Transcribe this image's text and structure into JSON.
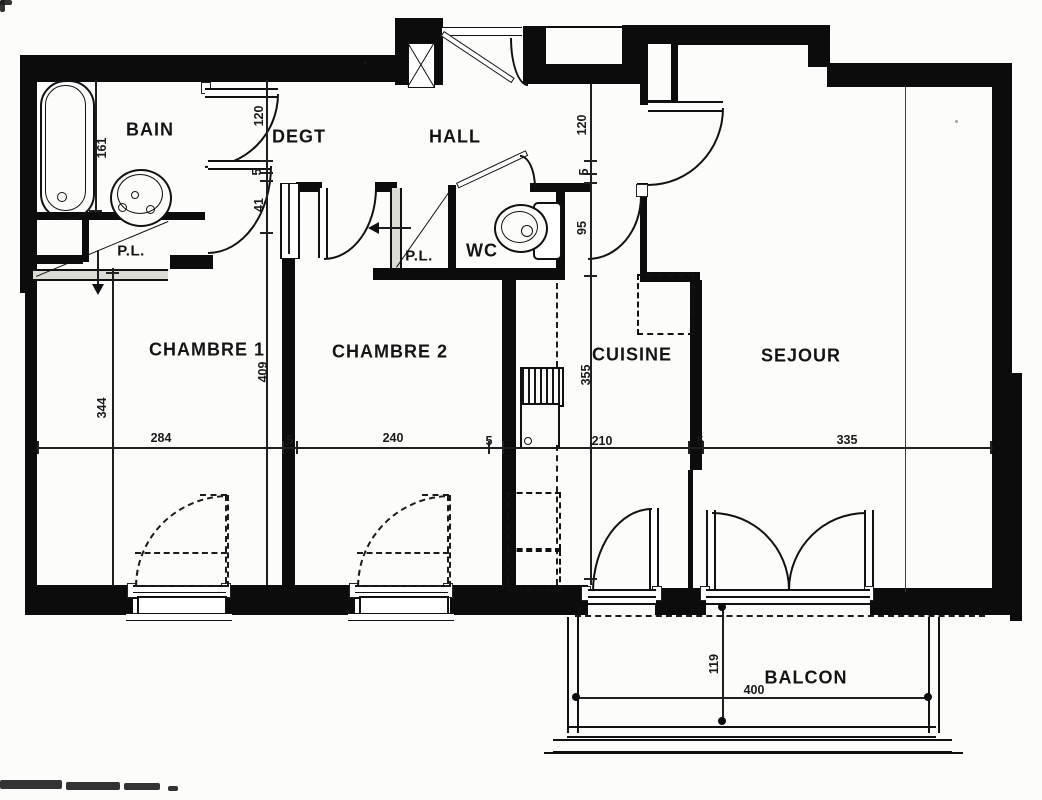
{
  "plan": {
    "title": "apartment-floor-plan-scan",
    "rooms": {
      "bain": "BAIN",
      "degt": "DEGT",
      "hall": "HALL",
      "wc": "WC",
      "placard_bain": "P.L.",
      "placard_hall": "P.L.",
      "chambre1": "CHAMBRE 1",
      "chambre2": "CHAMBRE 2",
      "cuisine": "CUISINE",
      "sejour": "SEJOUR",
      "balcon": "BALCON"
    },
    "dims": {
      "d161": "161",
      "d120_left": "120",
      "d5_left": "5",
      "d41": "41",
      "d120_right": "120",
      "d5_right": "5",
      "d95": "95",
      "d344": "344",
      "d409": "409",
      "d355": "355",
      "d284": "284",
      "d5_a": "5",
      "d240": "240",
      "d5_b": "5",
      "d210": "210",
      "d5_c": "5",
      "d335": "335",
      "d119": "119",
      "d400": "400"
    }
  }
}
